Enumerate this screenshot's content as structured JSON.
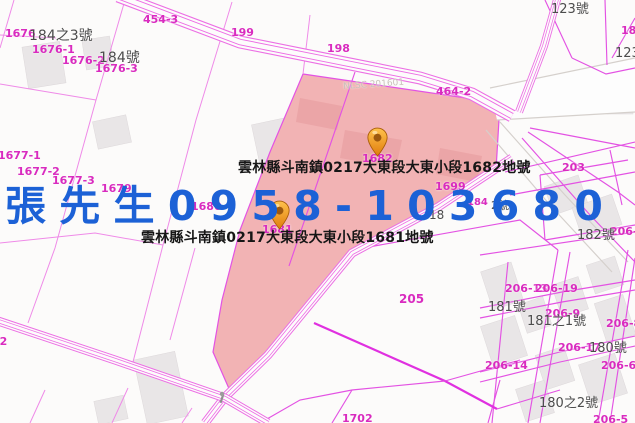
{
  "map": {
    "region": "雲林縣斗南鎮",
    "annotations": {
      "parcel_1682_label": "雲林縣斗南鎮0217大東段大東小段1682地號",
      "parcel_1681_label": "雲林縣斗南鎮0217大東段大東小段1681地號",
      "contact_overlay": "張 先 生 0 9 5 8 - 1 0 3 6 8 0"
    },
    "watermark": "NLSC 201601",
    "markers": [
      {
        "name": "marker-1682",
        "parcel": "1682",
        "x": 377,
        "y": 157,
        "icon": "orange-map-pin-icon"
      },
      {
        "name": "marker-1681",
        "parcel": "1681",
        "x": 279,
        "y": 230,
        "icon": "orange-map-pin-icon"
      }
    ],
    "colors": {
      "highlight_fill": "#f2b3b4",
      "boundary_magenta": "#e352e3",
      "label_magenta": "#d92bbf",
      "label_gray": "#4c4c4c",
      "contact_blue": "#1c61d6",
      "annotation_black": "#161616",
      "marker_orange": "#ef9322"
    },
    "labels": [
      {
        "t": "1676",
        "x": 5,
        "y": 28,
        "c": "m"
      },
      {
        "t": "1676-1",
        "x": 32,
        "y": 44,
        "c": "m"
      },
      {
        "t": "1676-2",
        "x": 62,
        "y": 55,
        "c": "m"
      },
      {
        "t": "1676-3",
        "x": 95,
        "y": 63,
        "c": "m"
      },
      {
        "t": "454-3",
        "x": 143,
        "y": 14,
        "c": "m"
      },
      {
        "t": "199",
        "x": 231,
        "y": 27,
        "c": "m"
      },
      {
        "t": "198",
        "x": 327,
        "y": 43,
        "c": "m"
      },
      {
        "t": "464-2",
        "x": 436,
        "y": 86,
        "c": "m"
      },
      {
        "t": "203",
        "x": 562,
        "y": 162,
        "c": "m"
      },
      {
        "t": "1677-1",
        "x": -2,
        "y": 150,
        "c": "m"
      },
      {
        "t": "1677-2",
        "x": 17,
        "y": 166,
        "c": "m"
      },
      {
        "t": "1677-3",
        "x": 52,
        "y": 175,
        "c": "m"
      },
      {
        "t": "1679",
        "x": 101,
        "y": 183,
        "c": "m"
      },
      {
        "t": "1680",
        "x": 191,
        "y": 201,
        "c": "m"
      },
      {
        "t": "1682",
        "x": 362,
        "y": 153,
        "c": "m"
      },
      {
        "t": "1699",
        "x": 435,
        "y": 181,
        "c": "m"
      },
      {
        "t": "1681",
        "x": 262,
        "y": 224,
        "c": "m"
      },
      {
        "t": "184",
        "x": 467,
        "y": 198,
        "c": "m",
        "s": 10
      },
      {
        "t": "205",
        "x": 399,
        "y": 293,
        "c": "m",
        "s": 12
      },
      {
        "t": "206-13",
        "x": 505,
        "y": 283,
        "c": "m"
      },
      {
        "t": "206-19",
        "x": 535,
        "y": 283,
        "c": "m"
      },
      {
        "t": "206-9",
        "x": 545,
        "y": 308,
        "c": "m"
      },
      {
        "t": "206-8",
        "x": 606,
        "y": 318,
        "c": "m"
      },
      {
        "t": "206-17",
        "x": 558,
        "y": 342,
        "c": "m"
      },
      {
        "t": "206-14",
        "x": 485,
        "y": 360,
        "c": "m"
      },
      {
        "t": "206-6",
        "x": 601,
        "y": 360,
        "c": "m"
      },
      {
        "t": "206-5",
        "x": 593,
        "y": 414,
        "c": "m"
      },
      {
        "t": "1702",
        "x": 342,
        "y": 413,
        "c": "m"
      },
      {
        "t": "02",
        "x": -8,
        "y": 336,
        "c": "m"
      },
      {
        "t": "18",
        "x": 621,
        "y": 25,
        "c": "m"
      },
      {
        "t": "206-18",
        "x": 610,
        "y": 226,
        "c": "m"
      },
      {
        "t": "184之3號",
        "x": 29,
        "y": 29,
        "c": "g",
        "s": 14
      },
      {
        "t": "184號",
        "x": 99,
        "y": 51,
        "c": "g",
        "s": 14
      },
      {
        "t": "123號",
        "x": 551,
        "y": 3,
        "c": "g"
      },
      {
        "t": "123",
        "x": 615,
        "y": 47,
        "c": "g"
      },
      {
        "t": "182號",
        "x": 577,
        "y": 229,
        "c": "g"
      },
      {
        "t": "181號",
        "x": 488,
        "y": 301,
        "c": "g"
      },
      {
        "t": "181之1號",
        "x": 527,
        "y": 315,
        "c": "g"
      },
      {
        "t": "180號",
        "x": 589,
        "y": 342,
        "c": "g"
      },
      {
        "t": "180之2號",
        "x": 539,
        "y": 397,
        "c": "g"
      },
      {
        "t": "18",
        "x": 429,
        "y": 209,
        "c": "g",
        "s": 12
      },
      {
        "t": "2號",
        "x": 491,
        "y": 200,
        "c": "g",
        "s": 11
      },
      {
        "t": "NLSC 201601",
        "x": 343,
        "y": 83,
        "c": "f",
        "r": -4
      }
    ]
  }
}
